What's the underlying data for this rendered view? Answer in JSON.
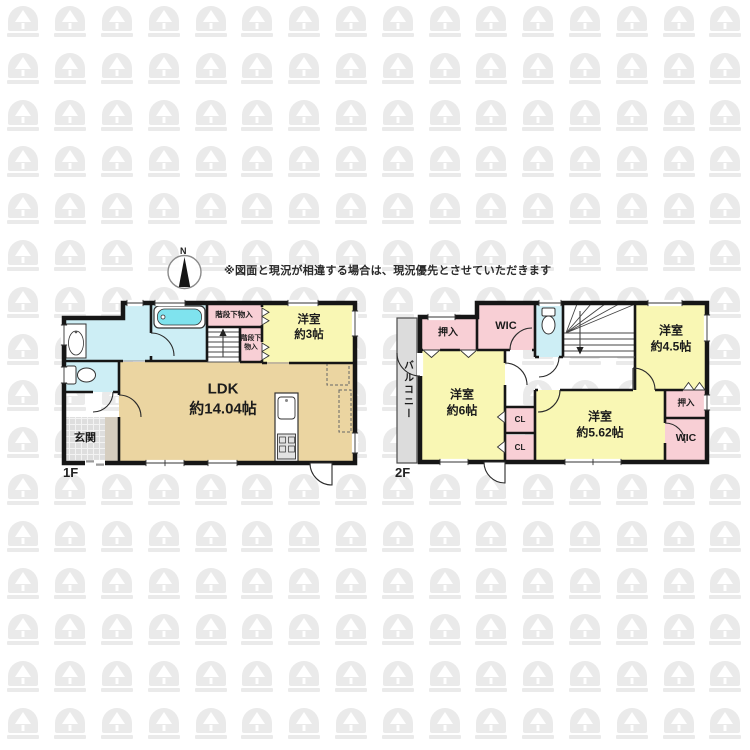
{
  "note": {
    "text": "※図面と現況が相違する場合は、現況優先とさせていただきます"
  },
  "compass": {
    "north_label": "N"
  },
  "palette": {
    "wall": "#161616",
    "room_yellow": "#f9f7b4",
    "room_pink": "#f8cfd5",
    "room_cyan": "#cdeef5",
    "tub_water": "#7fe3ee",
    "ldk_tan": "#ebd5a1",
    "balcony_gray": "#dcdcdc",
    "entrance_tile": "#dedede",
    "entrance_step": "#d5cdbf",
    "watermark": "#eaeaea"
  },
  "floor1": {
    "label": "1F",
    "rooms": {
      "ldk": "LDK\n約14.04帖",
      "western3": "洋室\n約3帖",
      "entrance": "玄関",
      "under_stairs_storage": "階段下物入",
      "under_stairs_storage_small": "階段下\n物入"
    }
  },
  "floor2": {
    "label": "2F",
    "rooms": {
      "balcony": "バルコニー",
      "oshiire_left": "押入",
      "wic_top": "WIC",
      "western6": "洋室\n約6帖",
      "western45": "洋室\n約4.5帖",
      "western562": "洋室\n約5.62帖",
      "cl_upper": "CL",
      "cl_lower": "CL",
      "oshiire_right": "押入",
      "wic_bottom": "WIC"
    }
  }
}
